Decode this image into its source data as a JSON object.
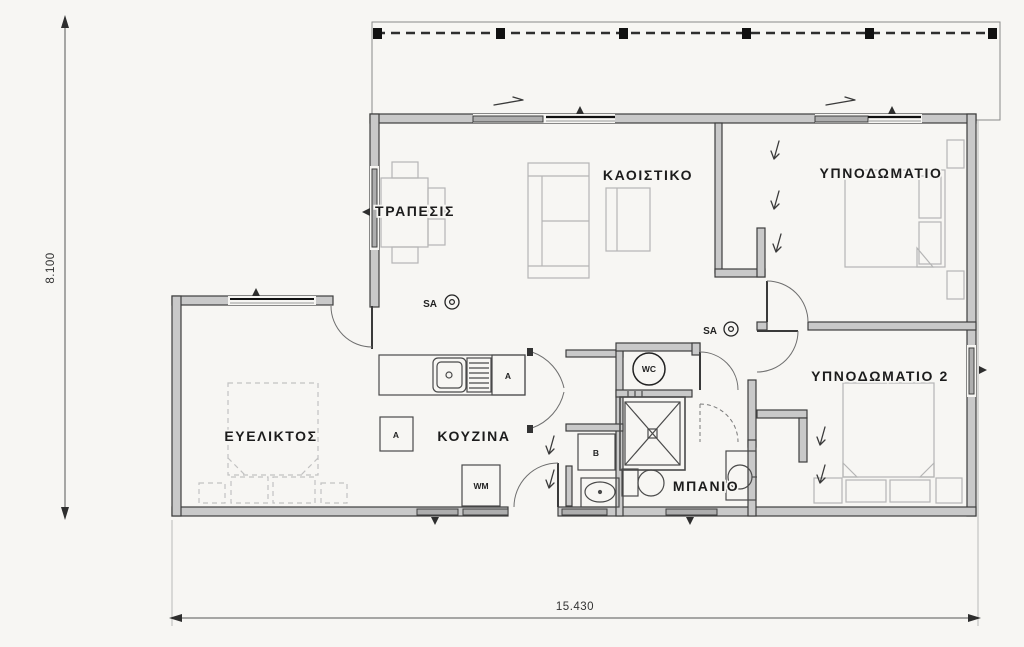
{
  "plan": {
    "rooms": {
      "dining": {
        "label": "ΤΡΑΠΕΣΙΣ"
      },
      "living": {
        "label": "ΚΑΟΙΣΤΙΚΟ"
      },
      "bedroom1": {
        "label": "ΥΠΝΟΔΩΜΑΤΙΟ"
      },
      "bedroom2": {
        "label": "ΥΠΝΟΔΩΜΑΤΙΟ 2"
      },
      "flexible": {
        "label": "ΕΥΕΛΙΚΤΟΣ"
      },
      "kitchen": {
        "label": "ΚΟΥΖΙΝΑ"
      },
      "bathroom": {
        "label": "ΜΠΑΝΙΟ"
      }
    },
    "symbols": {
      "smoke_alarm": "SA",
      "wc": "WC",
      "washing_machine": "WM",
      "appliance": "A",
      "boiler": "B"
    },
    "dimensions": {
      "overall_height_m": "8.100",
      "overall_width_m": "15.430"
    },
    "colors": {
      "background": "#f7f6f3",
      "wall_fill": "#c9c9c9",
      "wall_stroke": "#3e3e3e",
      "furniture": "#b5b5b5",
      "fixtures": "#4a4a4a",
      "text": "#1c1c1c"
    }
  }
}
